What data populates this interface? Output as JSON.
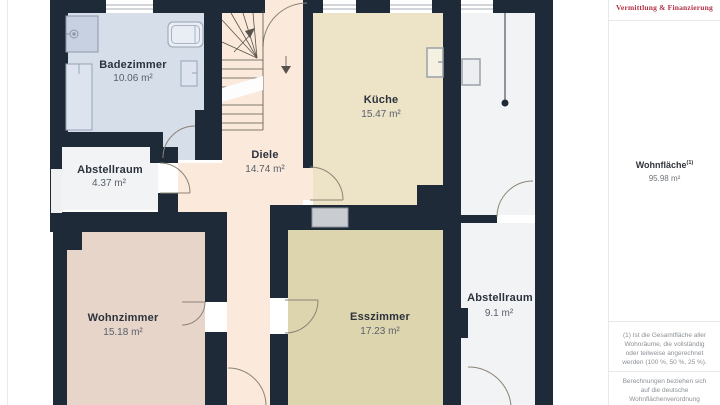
{
  "floor_plan": {
    "wall_color": "#1e2a38",
    "rooms": [
      {
        "name": "Badezimmer",
        "area": "10.06 m²",
        "color": "#d6deea"
      },
      {
        "name": "Abstellraum",
        "area": "4.37 m²",
        "color": "#f2f3f5"
      },
      {
        "name": "Diele",
        "area": "14.74 m²",
        "color": "#fbeadb"
      },
      {
        "name": "Küche",
        "area": "15.47 m²",
        "color": "#ede4c7"
      },
      {
        "name": "Wohnzimmer",
        "area": "15.18 m²",
        "color": "#e8d5c9"
      },
      {
        "name": "Esszimmer",
        "area": "17.23 m²",
        "color": "#ddd5ae"
      },
      {
        "name": "Abstellraum",
        "area": "9.1 m²",
        "color": "#f2f3f5"
      }
    ]
  },
  "sidebar": {
    "logo_tagline": "Vermittlung & Finanzierung",
    "logo_color": "#b13046",
    "area_label": "Wohnfläche",
    "area_label_sup": "(1)",
    "area_value": "95.98 m²",
    "footnote_1": "(1) Ist die Gesamtfläche aller Wohnräume, die vollständig oder teilweise angerechnet werden (100 %, 50 %, 25 %).",
    "footnote_2": "Berechnungen beziehen sich auf die deutsche Wohnflächenverordnung (WoFlV). Maße sind ungefähre Angaben"
  }
}
